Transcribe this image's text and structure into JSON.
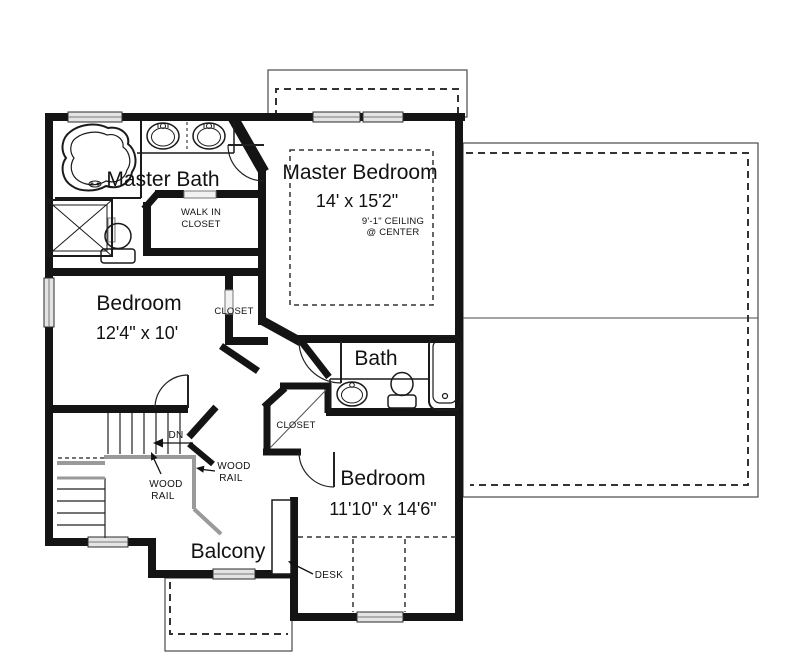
{
  "plan": {
    "rooms": {
      "master_bath": {
        "name": "Master Bath"
      },
      "walk_in_closet": {
        "line1": "WALK IN",
        "line2": "CLOSET"
      },
      "master_bedroom": {
        "name": "Master Bedroom",
        "dim": "14' x 15'2\"",
        "ceiling_line1": "9'-1\" CEILING",
        "ceiling_line2": "@ CENTER"
      },
      "bedroom_left": {
        "name": "Bedroom",
        "dim": "12'4\" x 10'"
      },
      "closet_hall": {
        "name": "CLOSET"
      },
      "bath": {
        "name": "Bath"
      },
      "closet_lower": {
        "name": "CLOSET"
      },
      "bedroom_lower": {
        "name": "Bedroom",
        "dim": "11'10\" x 14'6\""
      },
      "balcony": {
        "name": "Balcony"
      }
    },
    "annotations": {
      "dn": "DN",
      "wood_rail_1": {
        "line1": "WOOD",
        "line2": "RAIL"
      },
      "wood_rail_2": {
        "line1": "WOOD",
        "line2": "RAIL"
      },
      "desk": "DESK"
    },
    "colors": {
      "wall": "#141414",
      "thin_line": "#2a2a2a",
      "rail": "#9a9a9a",
      "roof_line": "#4a4a4a",
      "dashed_line": "#333333",
      "window_fill": "#e4e4e4",
      "background": "#ffffff"
    }
  }
}
